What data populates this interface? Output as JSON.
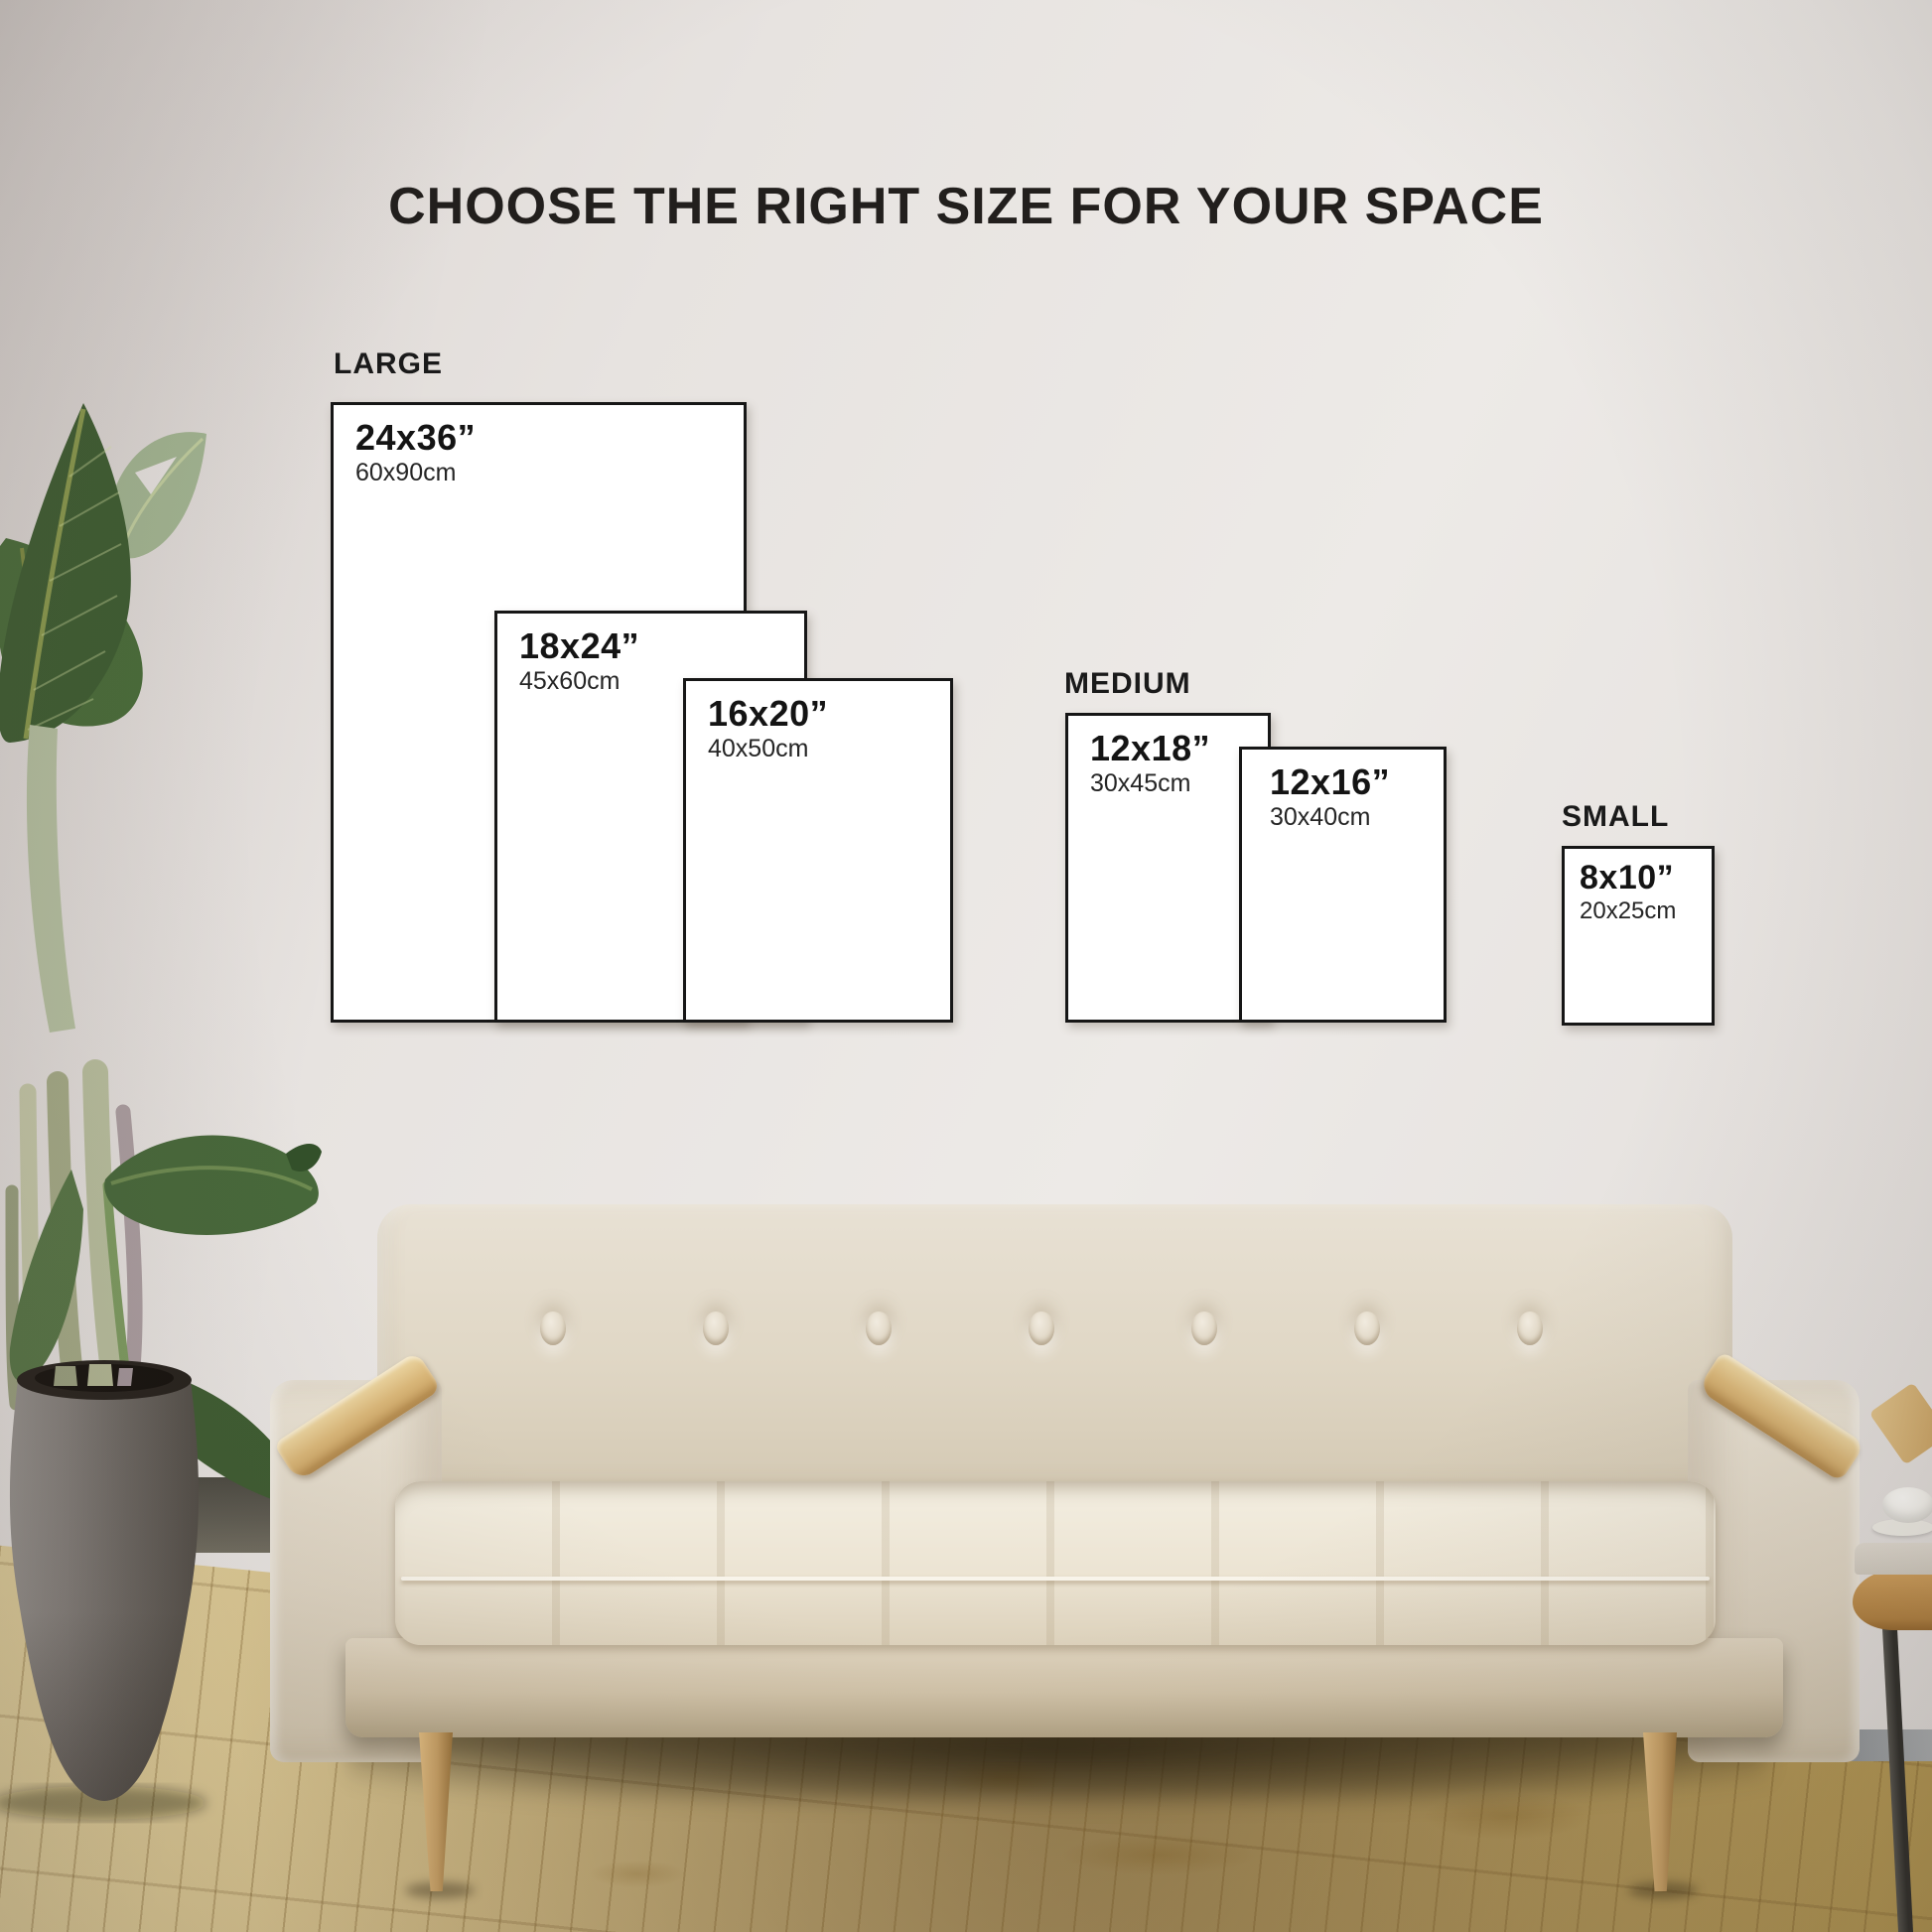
{
  "title": "CHOOSE THE RIGHT SIZE FOR YOUR SPACE",
  "groups": [
    {
      "label": "LARGE",
      "sizes": [
        {
          "inches": "24x36”",
          "cm": "60x90cm"
        },
        {
          "inches": "18x24”",
          "cm": "45x60cm"
        },
        {
          "inches": "16x20”",
          "cm": "40x50cm"
        }
      ]
    },
    {
      "label": "MEDIUM",
      "sizes": [
        {
          "inches": "12x18”",
          "cm": "30x45cm"
        },
        {
          "inches": "12x16”",
          "cm": "30x40cm"
        }
      ]
    },
    {
      "label": "SMALL",
      "sizes": [
        {
          "inches": "8x10”",
          "cm": "20x25cm"
        }
      ]
    }
  ],
  "palette": {
    "wall": "#e8e4e1",
    "floor": "#d2bc85",
    "box_border": "#161616",
    "box_fill": "#ffffff",
    "text": "#1d1b19",
    "sofa_fabric": "#ded4c2",
    "sofa_cushion": "#efe9dc",
    "armrest_wood": "#d3b277",
    "leg_wood": "#c09a60",
    "pot_gray": "#716d69",
    "leaf_green": "#41612f",
    "leaf_light": "#9fb48f"
  }
}
